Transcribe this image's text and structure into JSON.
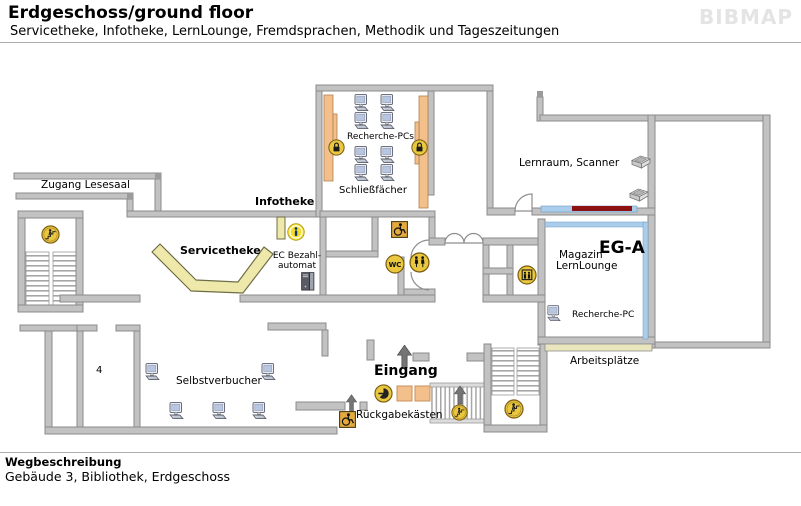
{
  "header": {
    "title": "Erdgeschoss/ground floor",
    "subtitle": "Servicetheke, Infotheke, LernLounge, Fremdsprachen, Methodik und Tageszeitungen",
    "logo": "BIBMAP"
  },
  "footer": {
    "heading": "Wegbeschreibung",
    "description": "Gebäude 3, Bibliothek, Erdgeschoss"
  },
  "map": {
    "labels": {
      "zugang_lesesaal": "Zugang Lesesaal",
      "infotheke": "Infotheke",
      "servicetheke": "Servicetheke",
      "recherche_pcs": "Recherche-PCs",
      "schliessfaecher": "Schließfächer",
      "lernraum_scanner": "Lernraum, Scanner",
      "magazin": "Magazin",
      "room_code": "EG-A",
      "lernlounge": "LernLounge",
      "recherche_pc": "Recherche-PC",
      "arbeitsplaetze": "Arbeitsplätze",
      "ec_automat_line1": "EC Bezahl-",
      "ec_automat_line2": "automat",
      "selbstverbucher": "Selbstverbucher",
      "room_number": "4",
      "eingang": "Eingang",
      "rueckgabekaesten": "Rückgabekästen",
      "wc_icon_text": "WC"
    },
    "colors": {
      "wall": "#c2c2c2",
      "wall_border": "#8b8b8b",
      "desk_yellow": "#eee8aa",
      "locker_orange": "#f3c08c",
      "highlight_blue": "#a9cdea",
      "highlight_red": "#8e1111",
      "icon_yellow": "#e9c73f"
    }
  }
}
